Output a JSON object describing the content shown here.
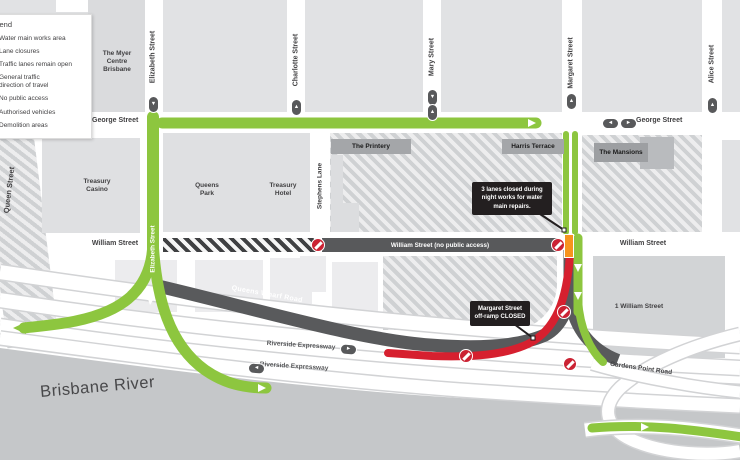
{
  "legend": {
    "title": "Legend",
    "items": [
      "Water main works area",
      "Lane closures",
      "Traffic lanes remain open",
      "General traffic direction of travel",
      "No public access",
      "Authorised vehicles",
      "Demolition areas"
    ]
  },
  "streets": {
    "george": "George Street",
    "elizabeth": "Elizabeth Street",
    "charlotte": "Charlotte Street",
    "mary": "Mary Street",
    "margaret": "Margaret Street",
    "alice": "Alice Street",
    "queen": "Queen Street",
    "stephens": "Stephens Lane",
    "william": "William Street",
    "william_closed": "William Street (no public access)",
    "queens_wharf": "Queens Wharf Road",
    "riverside": "Riverside Expressway",
    "gardens_point": "Gardens Point Road"
  },
  "buildings": {
    "myer": "The Myer Centre Brisbane",
    "treasury_casino": "Treasury Casino",
    "queens_park": "Queens Park",
    "treasury_hotel": "Treasury Hotel",
    "printery": "The Printery",
    "harris": "Harris Terrace",
    "mansions": "The Mansions",
    "one_william": "1 William Street"
  },
  "callouts": {
    "lane_closure": "3 lanes closed during night works for water main repairs.",
    "offramp": "Margaret Street off-ramp CLOSED"
  },
  "river": "Brisbane River",
  "icons": {
    "arrow_up": "▲",
    "arrow_down": "▼",
    "arrow_left": "◄",
    "arrow_right": "►"
  },
  "colors": {
    "route_green": "#8dc63f",
    "route_red": "#d6202f",
    "lane_closure_orange": "#f7941e",
    "road_dark": "#58595b",
    "river_grey": "#c5c7c9"
  }
}
